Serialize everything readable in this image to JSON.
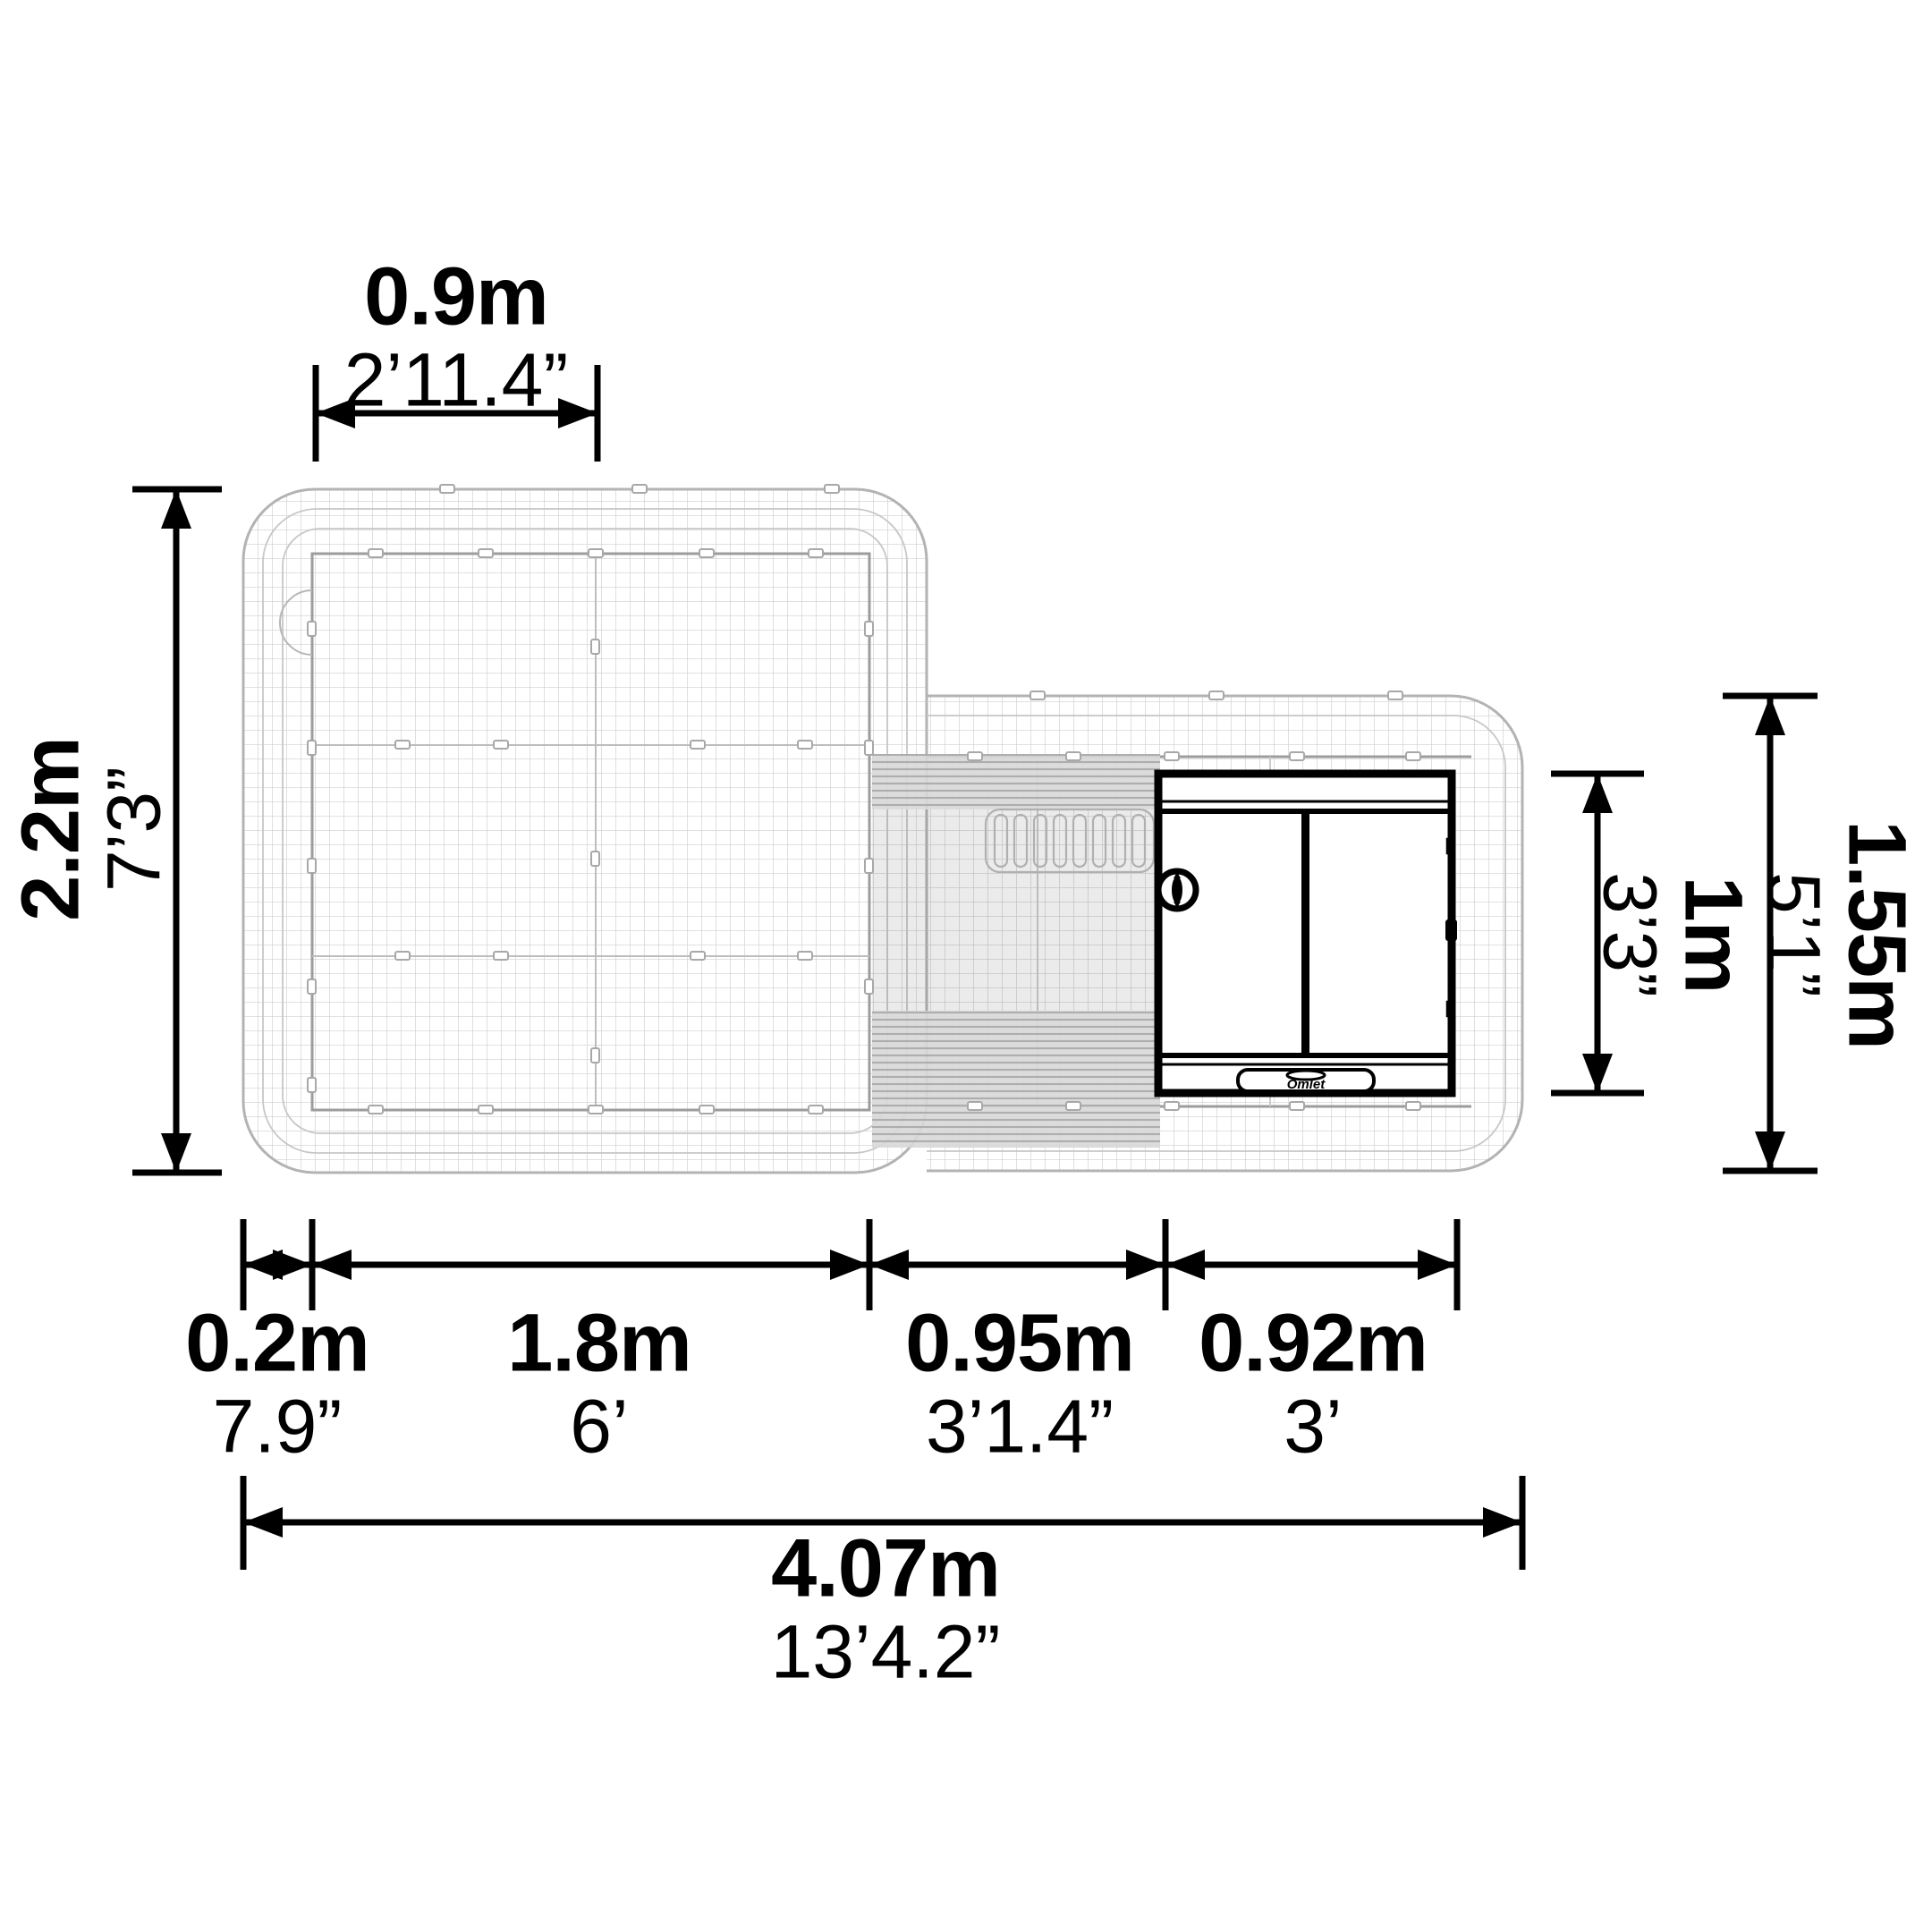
{
  "dimensions": {
    "top_width": {
      "metric": "0.9m",
      "imperial": "2’11.4”"
    },
    "left_height": {
      "metric": "2.2m",
      "imperial": "7’3”"
    },
    "coop_depth": {
      "metric": "1m",
      "imperial": "3’3”"
    },
    "side_height": {
      "metric": "1.55m",
      "imperial": "5’1”"
    },
    "bottom_segments": [
      {
        "metric": "0.2m",
        "imperial": "7.9”"
      },
      {
        "metric": "1.8m",
        "imperial": "6’"
      },
      {
        "metric": "0.95m",
        "imperial": "3’1.4”"
      },
      {
        "metric": "0.92m",
        "imperial": "3’"
      }
    ],
    "overall_width": {
      "metric": "4.07m",
      "imperial": "13’4.2”"
    }
  },
  "coop": {
    "logo": "Omlet"
  },
  "colors": {
    "dimension": "#000000",
    "mesh_line": "#cfcfcf",
    "outline_light": "#b3b3b3",
    "fence": "#9c9c9c",
    "cover_shade": "#9f9f9f",
    "coop_outline": "#000000"
  }
}
